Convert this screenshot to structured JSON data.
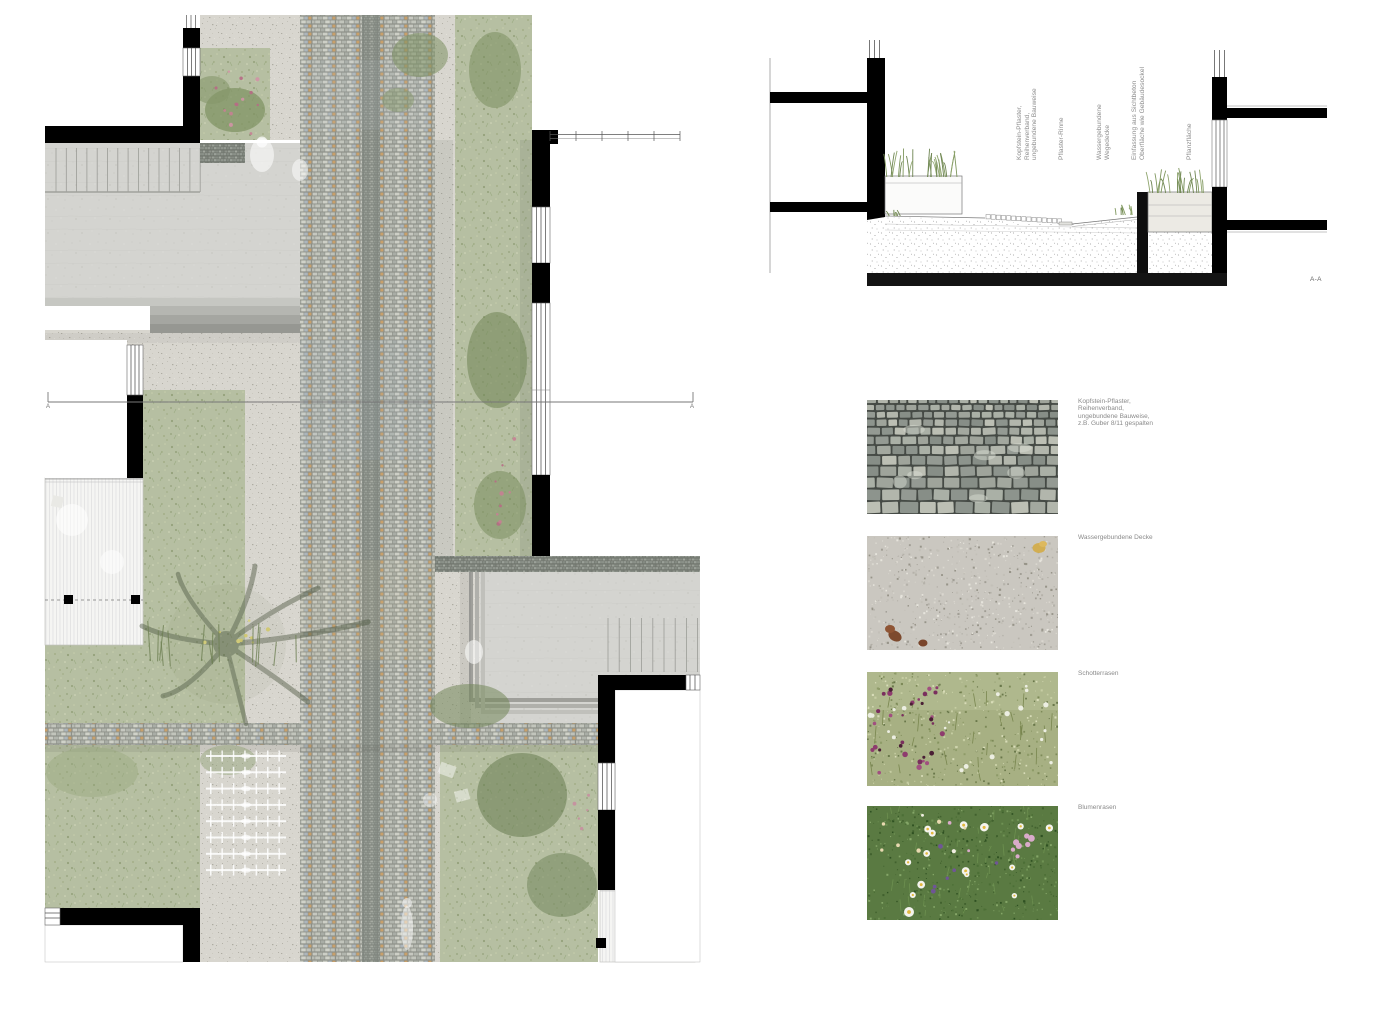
{
  "section": {
    "labels": {
      "pavement": "Kopfstein-Pflaster,\nReihenverband,\nungebundene Bauweise",
      "gutter": "Pflaster-Rinne",
      "path_surface": "Wassergebundene\nWegedecke",
      "edging": "Einfassung aus Sichtbeton\nOberfläche wie Gebäudesockel",
      "planting": "Pflanzfläche"
    },
    "mark": "A-A"
  },
  "plan": {
    "section_line": {
      "start_label": "A",
      "end_label": "A"
    }
  },
  "legend": {
    "items": [
      {
        "id": "kopfstein",
        "label": "Kopfstein-Pflaster,\nReihenverband,\nungebundene Bauweise,\nz.B. Guber 8/11 gespalten"
      },
      {
        "id": "wassergebunden",
        "label": "Wassergebundene Decke"
      },
      {
        "id": "schotterrasen",
        "label": "Schotterrasen"
      },
      {
        "id": "blumenrasen",
        "label": "Blumenrasen"
      }
    ]
  },
  "colors": {
    "wall_black": "#000000",
    "meadow_green": "#b6bfa2",
    "shrub_green": "#72865a",
    "gravel_grey": "#d8d6cf",
    "cobble_grey": "#c6c8c0",
    "cobble_tan": "#c9a06a",
    "concrete_grey": "#d4d4d0",
    "label_grey": "#8c8c8c"
  }
}
